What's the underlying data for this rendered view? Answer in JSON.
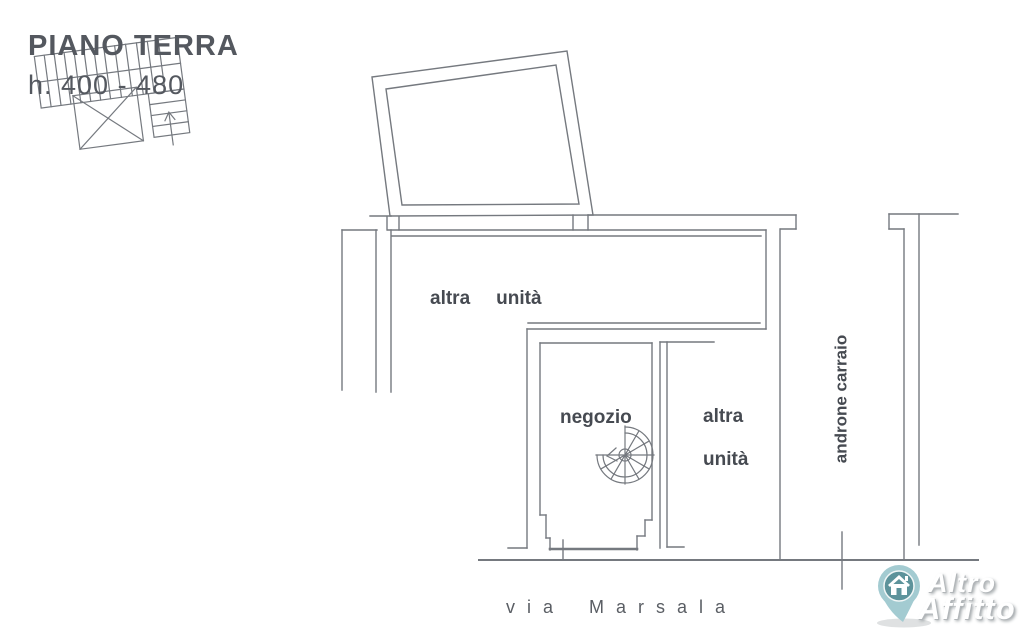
{
  "theme": {
    "line-color": "#75797f",
    "text-color": "#464a51",
    "title-color": "#54585f",
    "pin-outer": "#a3cbd1",
    "pin-inner": "#5d939b",
    "brand-text": "#ffffff",
    "brand-shadow": "#b2b6b9",
    "bg": "#ffffff"
  },
  "title": {
    "floor": "PIANO TERRA",
    "height_range": "h. 400 - 480"
  },
  "plan": {
    "labels": {
      "unit_top": {
        "w1": "altra",
        "w2": "unità"
      },
      "shop": "negozio",
      "unit_right": {
        "l1": "altra",
        "l2": "unità"
      },
      "corridor": "androne carraio",
      "street": {
        "w1": "via",
        "w2": "Marsala"
      }
    }
  },
  "watermark": {
    "line1": "Altro",
    "line2": "Affitto"
  }
}
